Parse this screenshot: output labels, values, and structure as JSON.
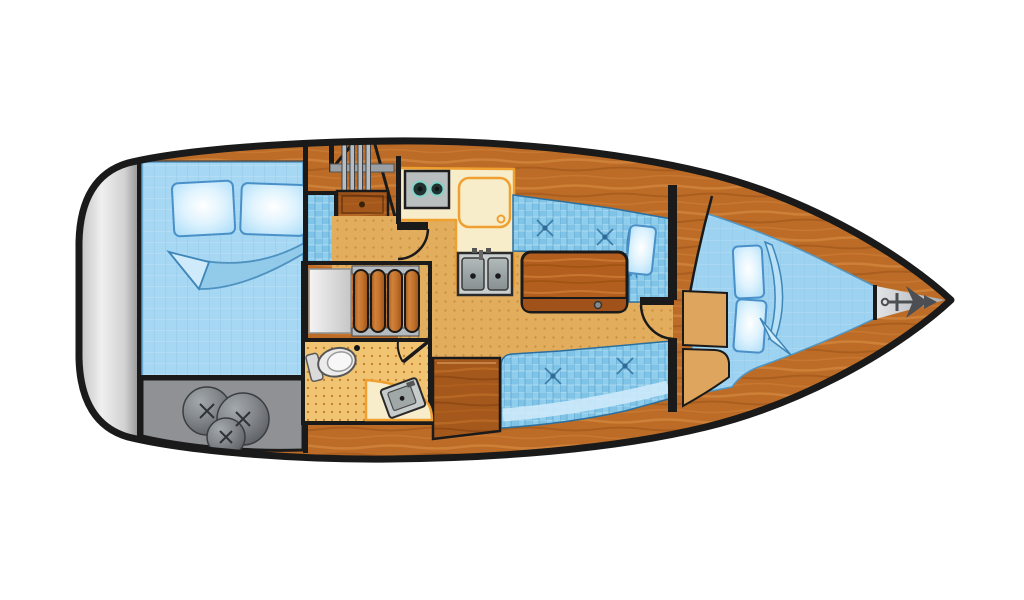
{
  "page": {
    "background": "#ffffff"
  },
  "plan": {
    "type": "boat-floor-plan",
    "orientation": "bow-right",
    "areas": [
      {
        "id": "transom-platform",
        "features": [
          "silver-swim-platform"
        ]
      },
      {
        "id": "aft-cabin",
        "features": [
          "double-berth",
          "two-pillows",
          "folded-sheet"
        ]
      },
      {
        "id": "engine-compartment",
        "features": [
          "three-fenders"
        ]
      },
      {
        "id": "companionway",
        "features": [
          "ladder-steps",
          "storage-drawer"
        ]
      },
      {
        "id": "nav-station",
        "features": [
          "chart-table",
          "slatted-seat"
        ]
      },
      {
        "id": "head",
        "features": [
          "toilet",
          "angled-sink",
          "counter",
          "door"
        ]
      },
      {
        "id": "galley",
        "features": [
          "two-burner-stove",
          "icebox-lid",
          "double-sink",
          "counter"
        ]
      },
      {
        "id": "salon",
        "features": [
          "port-settee",
          "starboard-settee",
          "folding-table",
          "cushion-tufts",
          "pillow",
          "blanket"
        ]
      },
      {
        "id": "v-berth",
        "features": [
          "v-bed",
          "two-pillows",
          "blanket",
          "door",
          "floor-wedge"
        ]
      },
      {
        "id": "anchor-locker",
        "features": [
          "anchor"
        ]
      }
    ]
  },
  "colors": {
    "hull_outline": "#1a1a1a",
    "deck_wood": "#bd6c27",
    "dark_wood": "#a4581b",
    "table_wood": "#b25e1e",
    "floor_tan": "#e3ad5e",
    "head_floor": "#f0c473",
    "counter_cream": "#f8edcb",
    "counter_edge": "#f0a030",
    "mattress_blue": "#a6d7f3",
    "cushion_blue": "#7fc3e6",
    "vberth_blue": "#9dd2f0",
    "pillow_blue": "#bee6fa",
    "pillow_edge": "#4a90c8",
    "blanket_edge": "#3e86b8",
    "stainless": "#b9bebe",
    "appliance_dark": "#223030",
    "burner_ring": "#7fd4c8",
    "engine_gray": "#8f9194",
    "fender_gray": "#6e7276",
    "locker_left_bar": "#1a1a1a",
    "anchor_gray": "#4b4f53",
    "step_tan": "#dda55d",
    "rail_gray": "#9aa0a4"
  }
}
